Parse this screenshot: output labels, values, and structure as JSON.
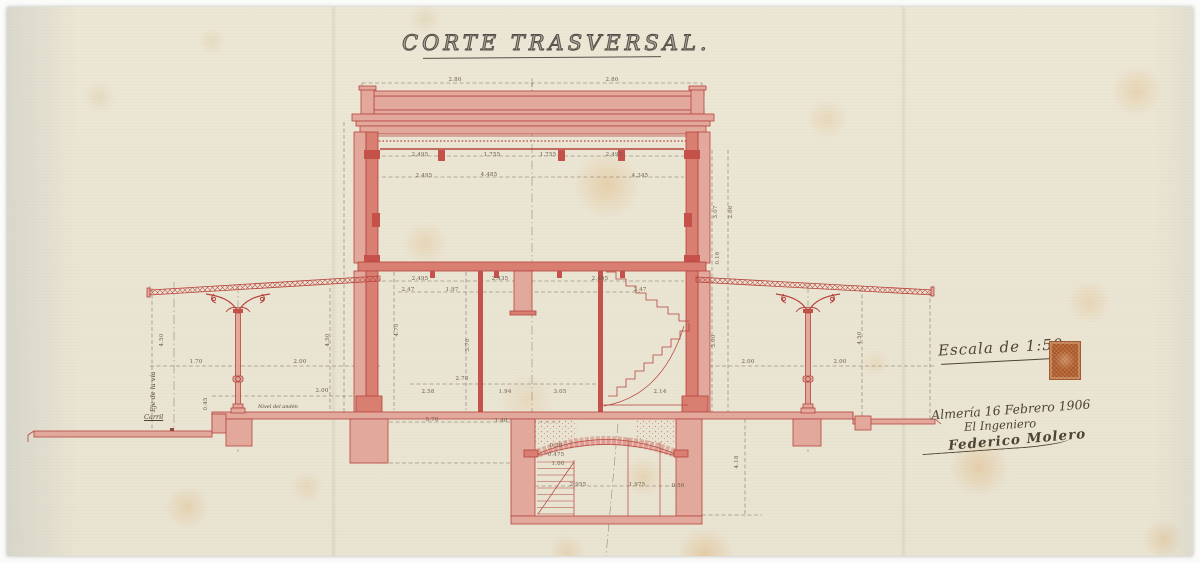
{
  "document": {
    "title": "CORTE TRASVERSAL.",
    "scale_label": "Escala de 1:50",
    "place_date": "Almería 16 Febrero 1906",
    "role": "El Ingeniero",
    "signature": "Federico Molero"
  },
  "annotations": {
    "track_axis": "Eje de la vía",
    "rail": "Carril",
    "platform_level": "Nivel del andén"
  },
  "colors": {
    "paper": "#eae4d2",
    "ink_red": "#b5443c",
    "ink_red_fill": "#e2a89c",
    "ink_strong": "#c4524a",
    "poche": "#d97f72",
    "dim_ink": "#6b5c4c",
    "hand_ink": "#4e4334",
    "stamp": "#c0703f"
  },
  "dimensions": [
    {
      "t": "2.80",
      "x": 455,
      "y": 80
    },
    {
      "t": "2.80",
      "x": 612,
      "y": 80
    },
    {
      "t": "2.495",
      "x": 420,
      "y": 155
    },
    {
      "t": "1.755",
      "x": 492,
      "y": 155
    },
    {
      "t": "1.755",
      "x": 548,
      "y": 155
    },
    {
      "t": "2.495",
      "x": 614,
      "y": 155
    },
    {
      "t": "2.495",
      "x": 424,
      "y": 176
    },
    {
      "t": "4.485",
      "x": 489,
      "y": 175
    },
    {
      "t": "4.345",
      "x": 640,
      "y": 176
    },
    {
      "t": "4.70",
      "x": 397,
      "y": 330,
      "r": -90
    },
    {
      "t": "3.70",
      "x": 468,
      "y": 345,
      "r": -90
    },
    {
      "t": "2.495",
      "x": 420,
      "y": 279
    },
    {
      "t": "2.435",
      "x": 500,
      "y": 279
    },
    {
      "t": "2.495",
      "x": 600,
      "y": 279
    },
    {
      "t": "2.47",
      "x": 408,
      "y": 290
    },
    {
      "t": "1.97",
      "x": 452,
      "y": 290
    },
    {
      "t": "2.47",
      "x": 640,
      "y": 290
    },
    {
      "t": "2.70",
      "x": 462,
      "y": 379
    },
    {
      "t": "2.58",
      "x": 428,
      "y": 392
    },
    {
      "t": "1.94",
      "x": 505,
      "y": 392
    },
    {
      "t": "3.05",
      "x": 560,
      "y": 392
    },
    {
      "t": "2.14",
      "x": 660,
      "y": 392
    },
    {
      "t": "1.70",
      "x": 196,
      "y": 362
    },
    {
      "t": "2.00",
      "x": 300,
      "y": 362
    },
    {
      "t": "4.50",
      "x": 162,
      "y": 340,
      "r": -90
    },
    {
      "t": "4.50",
      "x": 328,
      "y": 340,
      "r": -90
    },
    {
      "t": "2.00",
      "x": 322,
      "y": 391
    },
    {
      "t": "0.45",
      "x": 206,
      "y": 404,
      "r": -90
    },
    {
      "t": "2.00",
      "x": 748,
      "y": 362
    },
    {
      "t": "2.00",
      "x": 840,
      "y": 362
    },
    {
      "t": "3.00",
      "x": 714,
      "y": 341,
      "r": -90
    },
    {
      "t": "4.50",
      "x": 860,
      "y": 338,
      "r": -90
    },
    {
      "t": "3.07",
      "x": 716,
      "y": 212,
      "r": -90
    },
    {
      "t": "2.66",
      "x": 731,
      "y": 212,
      "r": -90
    },
    {
      "t": "0.16",
      "x": 718,
      "y": 258,
      "r": -90
    },
    {
      "t": "5.70",
      "x": 432,
      "y": 420
    },
    {
      "t": "1.40",
      "x": 501,
      "y": 421
    },
    {
      "t": "2.955",
      "x": 578,
      "y": 485
    },
    {
      "t": "1.975",
      "x": 637,
      "y": 485
    },
    {
      "t": "0.56",
      "x": 678,
      "y": 486
    },
    {
      "t": "4.18",
      "x": 737,
      "y": 462,
      "r": -90
    },
    {
      "t": "0.30",
      "x": 556,
      "y": 446
    },
    {
      "t": "0.475",
      "x": 556,
      "y": 455
    },
    {
      "t": "1.00",
      "x": 558,
      "y": 464
    }
  ]
}
